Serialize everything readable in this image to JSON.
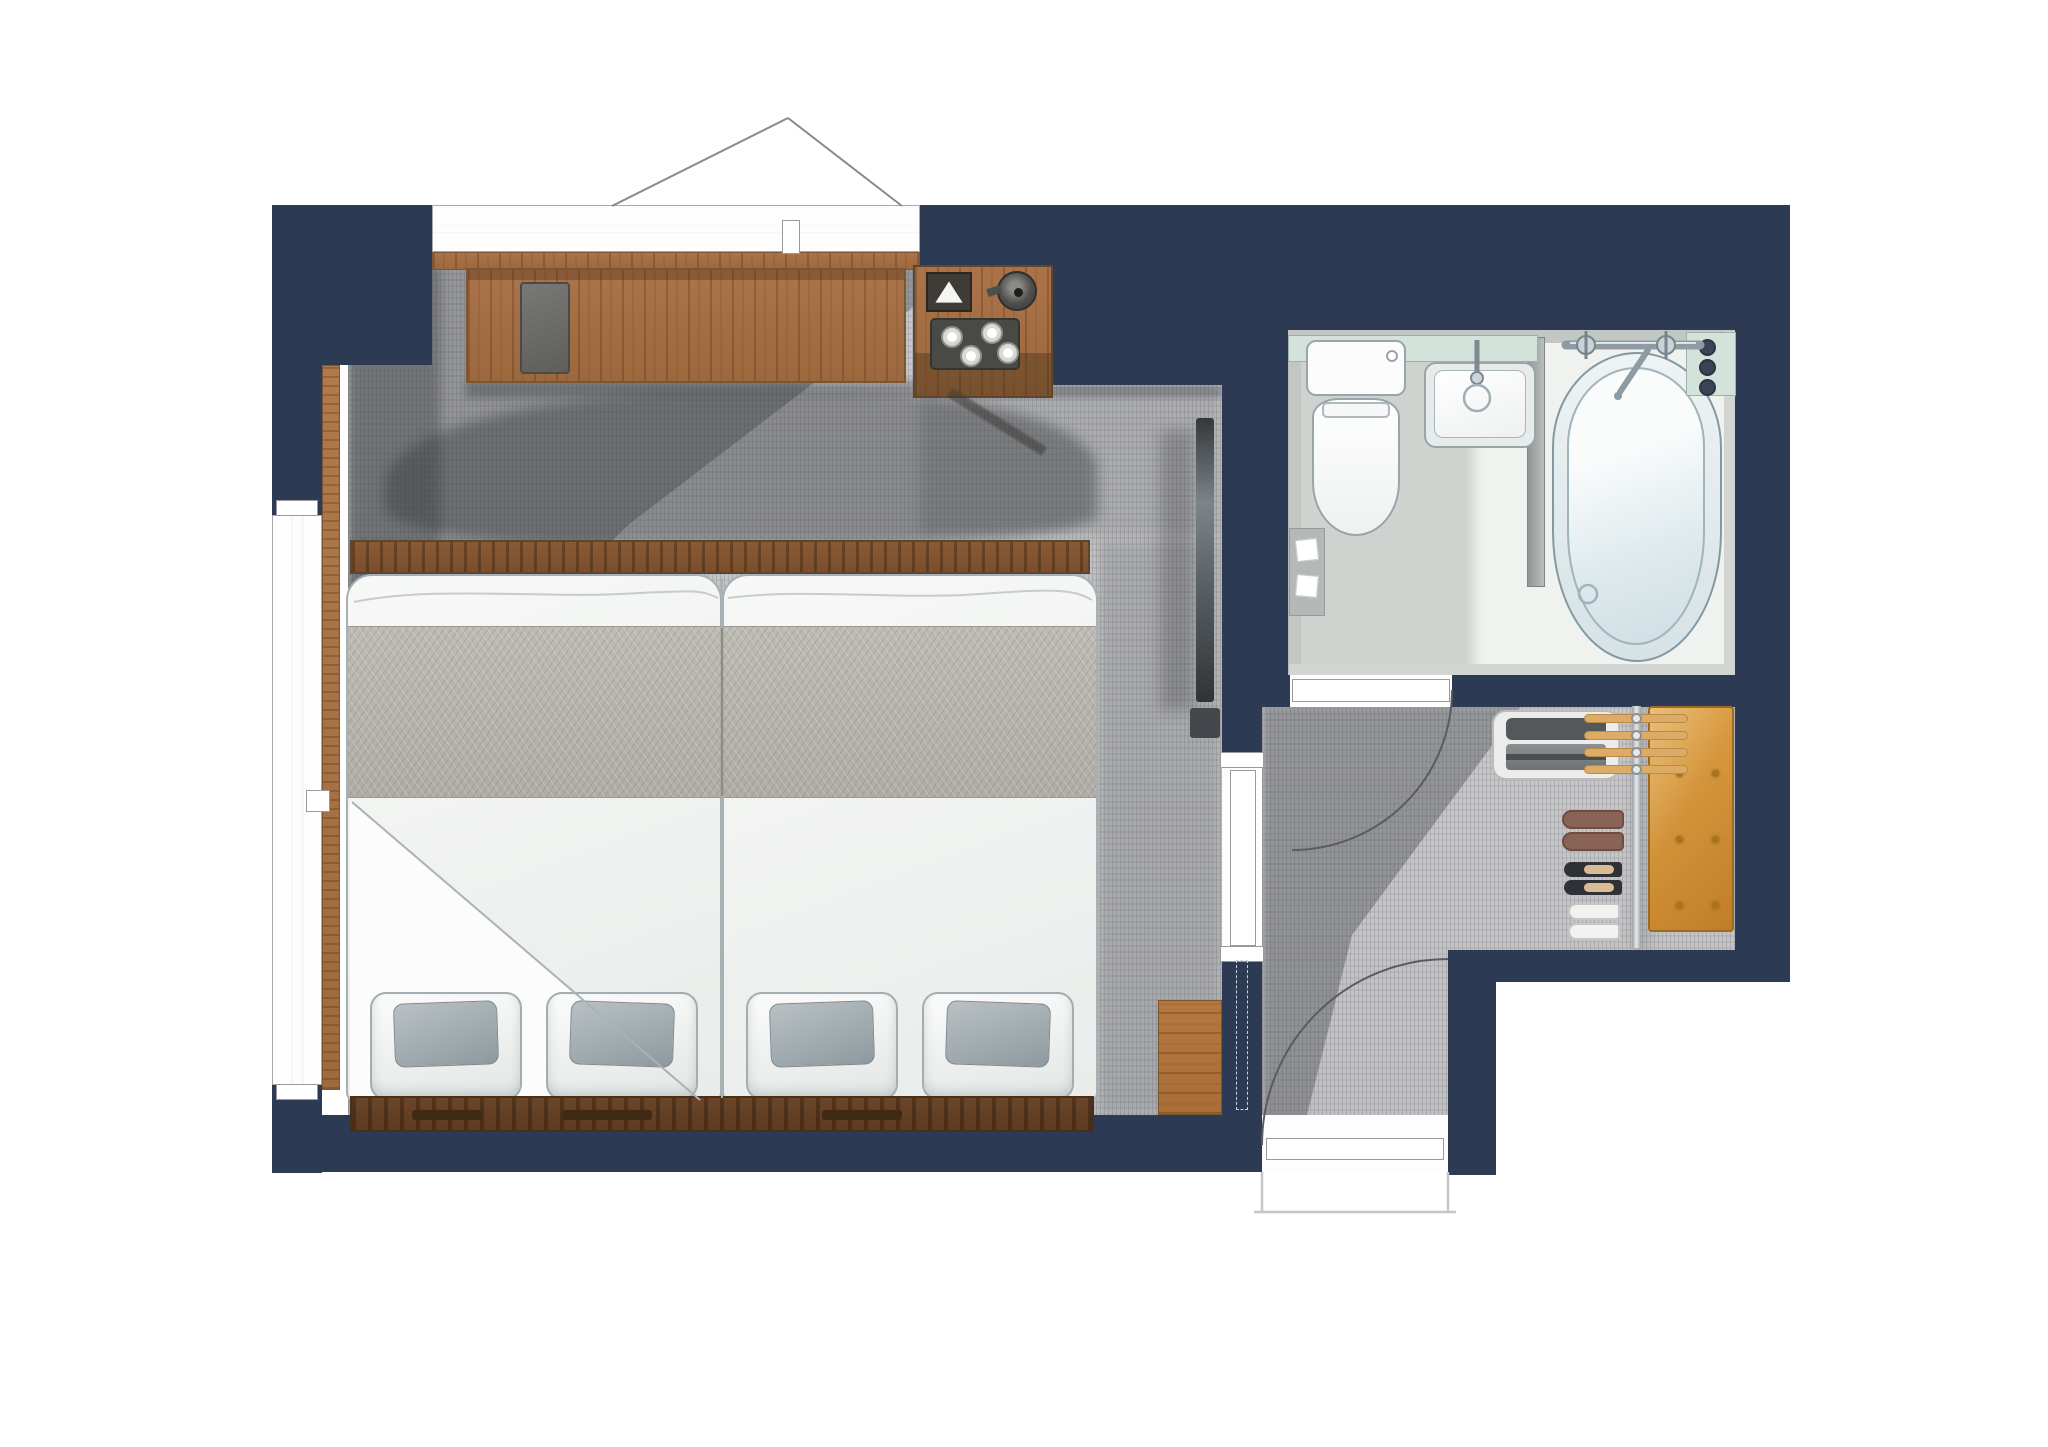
{
  "scene": {
    "type": "floor-plan-illustration",
    "description": "Hand-drawn top-view floor plan of a hotel twin room with bathroom and entry hall",
    "rooms": [
      "bedroom",
      "bathroom",
      "entry-hall"
    ],
    "text_labels": []
  },
  "palette": {
    "wall": "#2d3a53",
    "carpet": "#c8c8ca",
    "runner": "#bdbbb3",
    "wood": "#ab734a",
    "wood-floor": "#b5793f",
    "wood-dark": "#6b4527",
    "glass": "#d3e2da",
    "bench": "#d29032",
    "duvet": "#f4f5f4",
    "suitcase": "#55585b",
    "shoe-brown": "#8a6357",
    "shoe-black": "#2f3136",
    "slipper": "#f2f2f0",
    "chrome": "#8f9ba3",
    "arc-line": "#5a5c60"
  },
  "bedroom": {
    "furniture": [
      "twin-bed-left",
      "twin-bed-right",
      "foot-bench",
      "headboard",
      "desk",
      "desk-blotter",
      "tea-station",
      "kettle",
      "tissue-box",
      "cup-tray",
      "tv",
      "wood-floor-patch",
      "north-window",
      "west-window"
    ],
    "bed_count": 2,
    "pillow_count": 4,
    "cushion_count": 4,
    "teacup_count": 4
  },
  "bathroom": {
    "fixtures": [
      "toilet",
      "sink",
      "bathtub",
      "tub-faucet",
      "sink-faucet",
      "shower-control-panel",
      "towel-shelf"
    ],
    "control_knob_count": 3
  },
  "entry": {
    "items": [
      "luggage-shelf",
      "suitcase",
      "hanger-rail",
      "hangers",
      "leather-bench",
      "loafers",
      "heels",
      "slippers"
    ],
    "hanger_count": 4,
    "shoe_pair_count": 3,
    "bench_tuft_count": 6,
    "doors": [
      "bathroom-door",
      "sliding-door",
      "entrance-door"
    ]
  }
}
